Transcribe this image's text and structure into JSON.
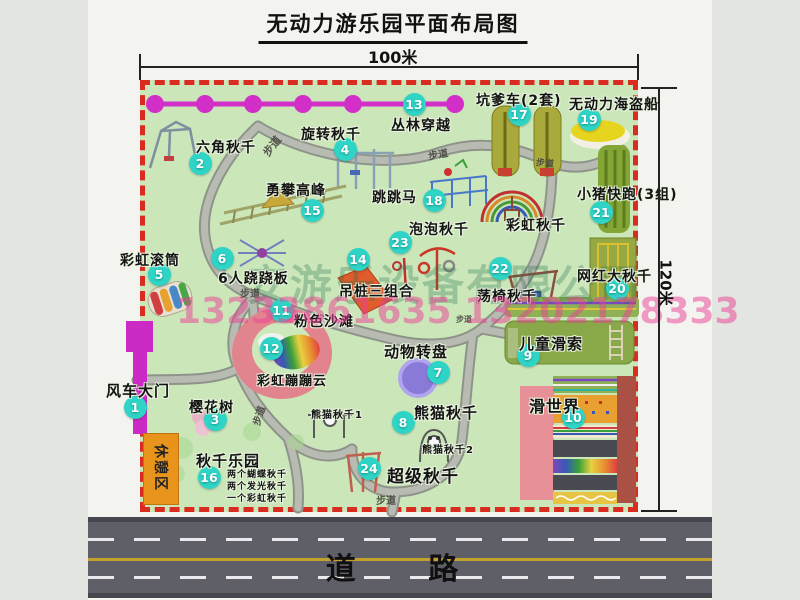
{
  "header": {
    "title": "无动力游乐园平面布局图"
  },
  "dims": {
    "width_label": "100米",
    "height_label": "120米"
  },
  "road": {
    "label": "道 路"
  },
  "watermarks": {
    "company": "安游乐设备有限公司",
    "phone": "13233861635 13202178333"
  },
  "rest_area": {
    "label": "休憩区"
  },
  "colors": {
    "badge_cyan": "#2ed4c6",
    "border_red": "#d92b20",
    "chain_magenta": "#d22ec8",
    "park_green": "#cbe7ba",
    "road_gray": "#5f5f68",
    "gate_magenta": "#cc2ac4",
    "rest_orange": "#e8941c"
  },
  "map": {
    "attractions": [
      {
        "num": "1",
        "label": "风车大门",
        "label_pos": [
          106,
          380
        ],
        "badge": [
          135,
          407
        ],
        "size": 15
      },
      {
        "num": "2",
        "label": "六角秋千",
        "label_pos": [
          196,
          137
        ],
        "badge": [
          200,
          163
        ],
        "size": 14
      },
      {
        "num": "3",
        "label": "樱花树",
        "label_pos": [
          189,
          397
        ],
        "badge": [
          215,
          419
        ],
        "size": 14
      },
      {
        "num": "4",
        "label": "旋转秋千",
        "label_pos": [
          301,
          124
        ],
        "badge": [
          345,
          149
        ],
        "size": 14
      },
      {
        "num": "5",
        "label": "彩虹滚筒",
        "label_pos": [
          120,
          250
        ],
        "badge": [
          159,
          274
        ],
        "size": 14
      },
      {
        "num": "6",
        "label": "6人跷跷板",
        "label_pos": [
          218,
          268
        ],
        "badge": [
          222,
          258
        ],
        "size": 14
      },
      {
        "num": "7",
        "label": "动物转盘",
        "label_pos": [
          384,
          341
        ],
        "badge": [
          438,
          372
        ],
        "size": 15
      },
      {
        "num": "8",
        "label": "熊猫秋千",
        "label_pos": [
          414,
          402
        ],
        "badge": [
          403,
          422
        ],
        "size": 15
      },
      {
        "num": "9",
        "label": "儿童滑索",
        "label_pos": [
          519,
          333
        ],
        "badge": [
          528,
          355
        ],
        "size": 15
      },
      {
        "num": "10",
        "label": "滑世界",
        "label_pos": [
          529,
          393
        ],
        "badge": [
          573,
          417
        ],
        "size": 16
      },
      {
        "num": "11",
        "label": "粉色沙滩",
        "label_pos": [
          294,
          311
        ],
        "badge": [
          281,
          310
        ],
        "size": 14
      },
      {
        "num": "12",
        "label": "彩虹蹦蹦云",
        "label_pos": [
          257,
          370
        ],
        "badge": [
          271,
          348
        ],
        "size": 13
      },
      {
        "num": "13",
        "label": "丛林穿越",
        "label_pos": [
          391,
          115
        ],
        "badge": [
          414,
          104
        ],
        "size": 14
      },
      {
        "num": "14",
        "label": "吊桩三组合",
        "label_pos": [
          339,
          281
        ],
        "badge": [
          358,
          259
        ],
        "size": 14
      },
      {
        "num": "15",
        "label": "勇攀高峰",
        "label_pos": [
          266,
          180
        ],
        "badge": [
          312,
          210
        ],
        "size": 14
      },
      {
        "num": "16",
        "label": "秋千乐园",
        "label_pos": [
          196,
          450
        ],
        "badge": [
          209,
          477
        ],
        "size": 15
      },
      {
        "num": "17",
        "label": "坑爹车(2套)",
        "label_pos": [
          476,
          90
        ],
        "badge": [
          519,
          114
        ],
        "size": 14
      },
      {
        "num": "18",
        "label": "跳跳马",
        "label_pos": [
          372,
          187
        ],
        "badge": [
          434,
          200
        ],
        "size": 14
      },
      {
        "num": "19",
        "label": "无动力海盗船",
        "label_pos": [
          569,
          94
        ],
        "badge": [
          589,
          119
        ],
        "size": 14
      },
      {
        "num": "20",
        "label": "网红大秋千",
        "label_pos": [
          577,
          266
        ],
        "badge": [
          617,
          288
        ],
        "size": 14
      },
      {
        "num": "21",
        "label": "小猪快跑(3组)",
        "label_pos": [
          577,
          184
        ],
        "badge": [
          601,
          212
        ],
        "size": 14
      },
      {
        "num": "22",
        "label": "荡椅秋千",
        "label_pos": [
          477,
          286
        ],
        "badge": [
          500,
          268
        ],
        "size": 14
      },
      {
        "num": "23",
        "label": "泡泡秋千",
        "label_pos": [
          409,
          219
        ],
        "badge": [
          400,
          242
        ],
        "size": 14
      },
      {
        "num": "24",
        "label": "超级秋千",
        "label_pos": [
          387,
          462
        ],
        "badge": [
          369,
          468
        ],
        "size": 17
      }
    ],
    "extra_labels": [
      {
        "text": "彩虹秋千",
        "pos": [
          506,
          215
        ],
        "size": 14
      },
      {
        "text": "熊猫秋千1",
        "pos": [
          311,
          406
        ],
        "size": 10
      },
      {
        "text": "熊猫秋千2",
        "pos": [
          422,
          441
        ],
        "size": 10
      },
      {
        "text": "两个蝴蝶秋千",
        "pos": [
          227,
          467
        ],
        "size": 9
      },
      {
        "text": "两个发光秋千",
        "pos": [
          227,
          479
        ],
        "size": 9
      },
      {
        "text": "一个彩虹秋千",
        "pos": [
          227,
          491
        ],
        "size": 9
      }
    ],
    "path_labels": [
      {
        "text": "步道",
        "pos": [
          261,
          138
        ],
        "rot": -52,
        "size": 11
      },
      {
        "text": "步道",
        "pos": [
          428,
          146
        ],
        "rot": -10,
        "size": 10
      },
      {
        "text": "步道",
        "pos": [
          536,
          156
        ],
        "rot": 6,
        "size": 9
      },
      {
        "text": "步道",
        "pos": [
          240,
          285
        ],
        "rot": 0,
        "size": 10
      },
      {
        "text": "步道",
        "pos": [
          456,
          314
        ],
        "rot": 0,
        "size": 8
      },
      {
        "text": "步道",
        "pos": [
          248,
          408
        ],
        "rot": -72,
        "size": 10
      },
      {
        "text": "步道",
        "pos": [
          376,
          492
        ],
        "rot": 0,
        "size": 10
      }
    ]
  }
}
